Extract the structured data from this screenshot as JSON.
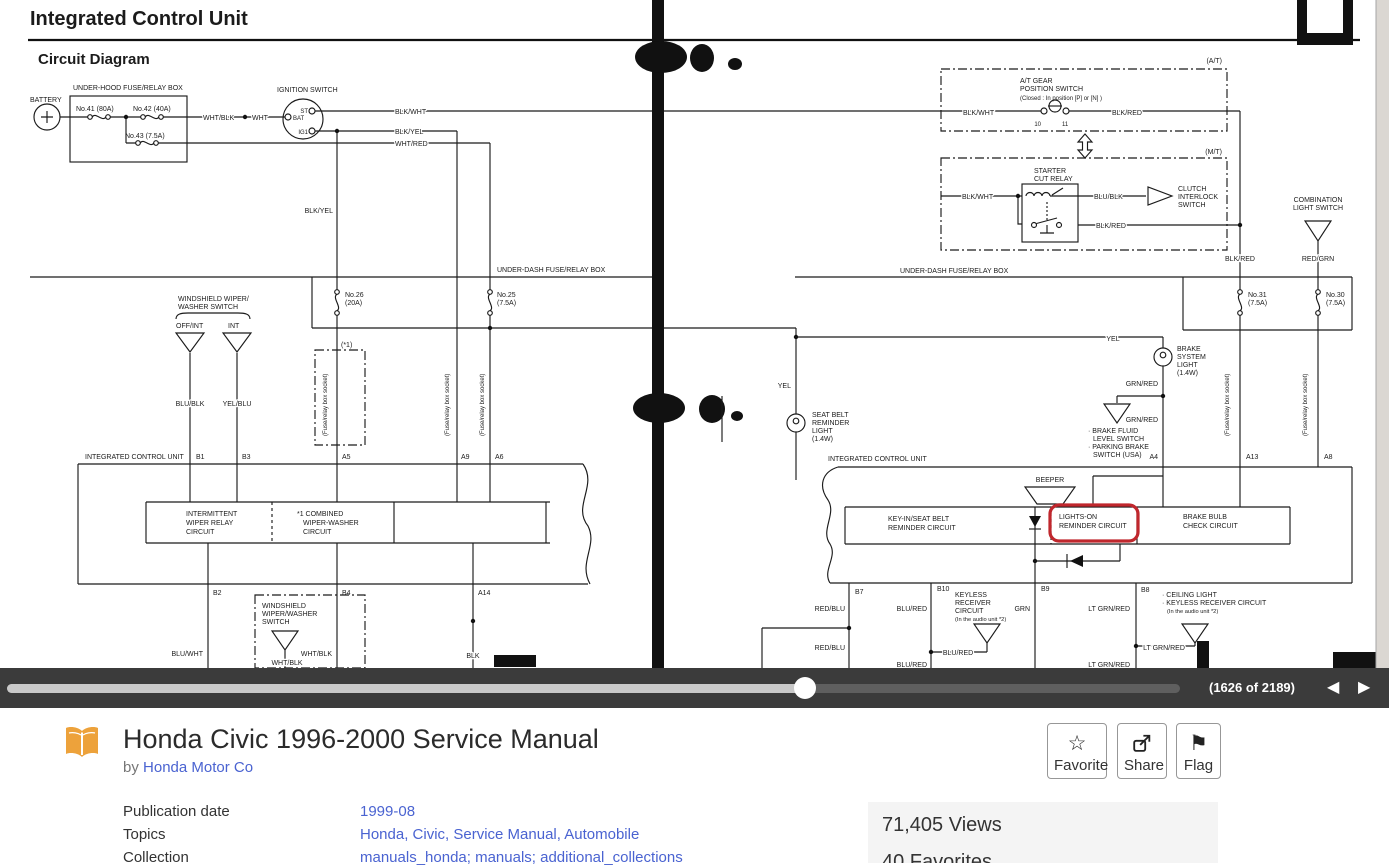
{
  "colors": {
    "highlight": "#c0272d",
    "link": "#4a63d1",
    "navbar_bg": "#3b3b3b",
    "ink": "#1b1b1b",
    "stats_bg": "#f4f4f4",
    "book_icon_orange": "#eda23b"
  },
  "viewer": {
    "page_indicator": "(1626 of 2189)",
    "prev_icon": "◀",
    "next_icon": "▶"
  },
  "book": {
    "title": "Honda Civic 1996-2000 Service Manual",
    "by_label": "by",
    "author": "Honda Motor Co",
    "actions": [
      {
        "label": "Favorite",
        "icon": "☆"
      },
      {
        "label": "Share",
        "icon": "share"
      },
      {
        "label": "Flag",
        "icon": "⚑"
      }
    ],
    "metadata": [
      {
        "label": "Publication date",
        "value": "1999-08"
      },
      {
        "label": "Topics",
        "value": "Honda, Civic, Service Manual, Automobile"
      },
      {
        "label": "Collection",
        "value": "manuals_honda; manuals; additional_collections"
      }
    ],
    "stats": {
      "views": "71,405 Views",
      "favorites_partial": "40 Favorites"
    }
  },
  "diagram": {
    "labels": [
      {
        "name": "page-heading",
        "x": 30,
        "y": 25,
        "t": "Integrated Control Unit",
        "s": 20,
        "b": 1
      },
      {
        "name": "section-heading",
        "x": 38,
        "y": 64,
        "t": "Circuit Diagram",
        "s": 15,
        "b": 1
      },
      {
        "name": "battery-label",
        "x": 30,
        "y": 102,
        "t": "BATTERY"
      },
      {
        "name": "underhood-box-label",
        "x": 73,
        "y": 90,
        "t": "UNDER-HOOD FUSE/RELAY BOX"
      },
      {
        "name": "fuse41-label",
        "x": 76,
        "y": 111,
        "t": "No.41 (80A)"
      },
      {
        "name": "fuse42-label",
        "x": 133,
        "y": 111,
        "t": "No.42 (40A)"
      },
      {
        "name": "fuse43-label",
        "x": 125,
        "y": 138,
        "t": "No.43 (7.5A)"
      },
      {
        "name": "wire-wht-blk",
        "x": 203,
        "y": 120,
        "t": "WHT/BLK",
        "h": 1
      },
      {
        "name": "wire-wht",
        "x": 252,
        "y": 120,
        "t": "WHT",
        "h": 1
      },
      {
        "name": "ignition-switch-label",
        "x": 277,
        "y": 92,
        "t": "IGNITION SWITCH"
      },
      {
        "name": "ign-st",
        "x": 308,
        "y": 113,
        "t": "ST",
        "a": "e",
        "s": 6
      },
      {
        "name": "ign-bat",
        "x": 293,
        "y": 120,
        "t": "BAT",
        "s": 6
      },
      {
        "name": "ign-ig1",
        "x": 308,
        "y": 134,
        "t": "IG1",
        "a": "e",
        "s": 6
      },
      {
        "name": "wire-blk-wht-1",
        "x": 395,
        "y": 114,
        "t": "BLK/WHT",
        "h": 1
      },
      {
        "name": "wire-blk-yel-1",
        "x": 395,
        "y": 134,
        "t": "BLK/YEL",
        "h": 1
      },
      {
        "name": "wire-wht-red",
        "x": 395,
        "y": 146,
        "t": "WHT/RED",
        "h": 1
      },
      {
        "name": "at-tag",
        "x": 1222,
        "y": 63,
        "t": "(A/T)",
        "a": "e"
      },
      {
        "name": "at-switch-label-1",
        "x": 1020,
        "y": 83,
        "t": "A/T GEAR"
      },
      {
        "name": "at-switch-label-2",
        "x": 1020,
        "y": 91,
        "t": "POSITION SWITCH"
      },
      {
        "name": "at-switch-label-3",
        "x": 1020,
        "y": 100,
        "t": "(Closed : In position [P] or [N] )",
        "s": 6
      },
      {
        "name": "at-term-10",
        "x": 1041,
        "y": 126,
        "t": "10",
        "a": "e",
        "s": 6
      },
      {
        "name": "at-term-11",
        "x": 1062,
        "y": 126,
        "t": "11",
        "s": 6
      },
      {
        "name": "wire-blk-wht-2",
        "x": 963,
        "y": 115,
        "t": "BLK/WHT",
        "h": 1
      },
      {
        "name": "wire-blk-red-1",
        "x": 1112,
        "y": 115,
        "t": "BLK/RED",
        "h": 1
      },
      {
        "name": "mt-tag",
        "x": 1222,
        "y": 154,
        "t": "(M/T)",
        "a": "e"
      },
      {
        "name": "starter-relay-label-1",
        "x": 1034,
        "y": 173,
        "t": "STARTER"
      },
      {
        "name": "starter-relay-label-2",
        "x": 1034,
        "y": 181,
        "t": "CUT RELAY"
      },
      {
        "name": "wire-blk-wht-3",
        "x": 962,
        "y": 199,
        "t": "BLK/WHT",
        "h": 1
      },
      {
        "name": "wire-blu-blk",
        "x": 1094,
        "y": 199,
        "t": "BLU/BLK",
        "h": 1
      },
      {
        "name": "clutch-label-1",
        "x": 1178,
        "y": 191,
        "t": "CLUTCH"
      },
      {
        "name": "clutch-label-2",
        "x": 1178,
        "y": 199,
        "t": "INTERLOCK"
      },
      {
        "name": "clutch-label-3",
        "x": 1178,
        "y": 207,
        "t": "SWITCH"
      },
      {
        "name": "wire-blk-red-2",
        "x": 1096,
        "y": 228,
        "t": "BLK/RED",
        "h": 1
      },
      {
        "name": "combo-label-1",
        "x": 1318,
        "y": 202,
        "t": "COMBINATION",
        "a": "m"
      },
      {
        "name": "combo-label-2",
        "x": 1318,
        "y": 210,
        "t": "LIGHT SWITCH",
        "a": "m"
      },
      {
        "name": "wire-red-grn",
        "x": 1318,
        "y": 261,
        "t": "RED/GRN",
        "a": "m",
        "h": 1
      },
      {
        "name": "wire-blk-red-3",
        "x": 1240,
        "y": 261,
        "t": "BLK/RED",
        "a": "m",
        "h": 1
      },
      {
        "name": "underdash-left-label",
        "x": 497,
        "y": 272,
        "t": "UNDER-DASH FUSE/RELAY BOX"
      },
      {
        "name": "underdash-right-label",
        "x": 900,
        "y": 273,
        "t": "UNDER-DASH FUSE/RELAY BOX"
      },
      {
        "name": "fuse26-label-1",
        "x": 345,
        "y": 297,
        "t": "No.26"
      },
      {
        "name": "fuse26-label-2",
        "x": 345,
        "y": 305,
        "t": "(20A)"
      },
      {
        "name": "fuse25-label-1",
        "x": 497,
        "y": 297,
        "t": "No.25"
      },
      {
        "name": "fuse25-label-2",
        "x": 497,
        "y": 305,
        "t": "(7.5A)"
      },
      {
        "name": "fuse31-label-1",
        "x": 1248,
        "y": 297,
        "t": "No.31"
      },
      {
        "name": "fuse31-label-2",
        "x": 1248,
        "y": 305,
        "t": "(7.5A)"
      },
      {
        "name": "fuse30-label-1",
        "x": 1326,
        "y": 297,
        "t": "No.30"
      },
      {
        "name": "fuse30-label-2",
        "x": 1326,
        "y": 305,
        "t": "(7.5A)"
      },
      {
        "name": "optional-box-label",
        "x": 341,
        "y": 347,
        "t": "(*1)"
      },
      {
        "name": "socket-label-1",
        "x": 327,
        "y": 436,
        "t": "(Fuse/relay box socket)",
        "r": 1,
        "s": 6
      },
      {
        "name": "socket-label-2",
        "x": 449,
        "y": 436,
        "t": "(Fuse/relay box socket)",
        "r": 1,
        "s": 6
      },
      {
        "name": "socket-label-3",
        "x": 484,
        "y": 436,
        "t": "(Fuse/relay box socket)",
        "r": 1,
        "s": 6
      },
      {
        "name": "socket-label-4",
        "x": 1229,
        "y": 436,
        "t": "(Fuse/relay box socket)",
        "r": 1,
        "s": 6
      },
      {
        "name": "socket-label-5",
        "x": 1307,
        "y": 436,
        "t": "(Fuse/relay box socket)",
        "r": 1,
        "s": 6
      },
      {
        "name": "wiper-switch-label-1",
        "x": 178,
        "y": 301,
        "t": "WINDSHIELD WIPER/"
      },
      {
        "name": "wiper-switch-label-2",
        "x": 178,
        "y": 309,
        "t": "WASHER SWITCH"
      },
      {
        "name": "wiper-offint-label",
        "x": 176,
        "y": 328,
        "t": "OFF/INT"
      },
      {
        "name": "wiper-int-label",
        "x": 228,
        "y": 328,
        "t": "INT"
      },
      {
        "name": "wire-blu-blk-2",
        "x": 190,
        "y": 406,
        "t": "BLU/BLK",
        "a": "m",
        "h": 1
      },
      {
        "name": "wire-yel-blu",
        "x": 237,
        "y": 406,
        "t": "YEL/BLU",
        "a": "m",
        "h": 1
      },
      {
        "name": "wire-blk-yel-2",
        "x": 333,
        "y": 213,
        "t": "BLK/YEL",
        "a": "e",
        "h": 1
      },
      {
        "name": "wire-yel-1",
        "x": 791,
        "y": 388,
        "t": "YEL",
        "a": "e",
        "h": 1
      },
      {
        "name": "wire-yel-2",
        "x": 1113,
        "y": 341,
        "t": "YEL",
        "a": "m",
        "h": 1
      },
      {
        "name": "seatbelt-label-1",
        "x": 812,
        "y": 417,
        "t": "SEAT BELT"
      },
      {
        "name": "seatbelt-label-2",
        "x": 812,
        "y": 425,
        "t": "REMINDER"
      },
      {
        "name": "seatbelt-label-3",
        "x": 812,
        "y": 433,
        "t": "LIGHT"
      },
      {
        "name": "seatbelt-label-4",
        "x": 812,
        "y": 441,
        "t": "(1.4W)"
      },
      {
        "name": "brakelight-label-1",
        "x": 1177,
        "y": 351,
        "t": "BRAKE"
      },
      {
        "name": "brakelight-label-2",
        "x": 1177,
        "y": 359,
        "t": "SYSTEM"
      },
      {
        "name": "brakelight-label-3",
        "x": 1177,
        "y": 367,
        "t": "LIGHT"
      },
      {
        "name": "brakelight-label-4",
        "x": 1177,
        "y": 375,
        "t": "(1.4W)"
      },
      {
        "name": "wire-grn-red-1",
        "x": 1158,
        "y": 386,
        "t": "GRN/RED",
        "a": "e",
        "h": 1
      },
      {
        "name": "wire-grn-red-2",
        "x": 1158,
        "y": 422,
        "t": "GRN/RED",
        "a": "e",
        "h": 1
      },
      {
        "name": "brakefluid-label-1",
        "x": 1088,
        "y": 433,
        "t": "· BRAKE FLUID"
      },
      {
        "name": "brakefluid-label-2",
        "x": 1093,
        "y": 441,
        "t": "LEVEL SWITCH"
      },
      {
        "name": "brakefluid-label-3",
        "x": 1088,
        "y": 449,
        "t": "· PARKING BRAKE"
      },
      {
        "name": "brakefluid-label-4",
        "x": 1093,
        "y": 457,
        "t": "SWITCH (USA)"
      },
      {
        "name": "icu-right-label",
        "x": 828,
        "y": 461,
        "t": "INTEGRATED CONTROL UNIT"
      },
      {
        "name": "beeper-label",
        "x": 1050,
        "y": 482,
        "t": "BEEPER",
        "a": "m"
      },
      {
        "name": "keyin-label-1",
        "x": 888,
        "y": 521,
        "t": "KEY-IN/SEAT BELT"
      },
      {
        "name": "keyin-label-2",
        "x": 888,
        "y": 530,
        "t": "REMINDER CIRCUIT"
      },
      {
        "name": "lightson-label-1",
        "x": 1059,
        "y": 519,
        "t": "LIGHTS-ON"
      },
      {
        "name": "lightson-label-2",
        "x": 1059,
        "y": 528,
        "t": "REMINDER CIRCUIT"
      },
      {
        "name": "brakebulb-label-1",
        "x": 1183,
        "y": 519,
        "t": "BRAKE BULB"
      },
      {
        "name": "brakebulb-label-2",
        "x": 1183,
        "y": 528,
        "t": "CHECK CIRCUIT"
      },
      {
        "name": "term-a4",
        "x": 1158,
        "y": 459,
        "t": "A4",
        "a": "e"
      },
      {
        "name": "term-a13",
        "x": 1246,
        "y": 459,
        "t": "A13"
      },
      {
        "name": "term-a8",
        "x": 1324,
        "y": 459,
        "t": "A8"
      },
      {
        "name": "icu-left-label",
        "x": 85,
        "y": 459,
        "t": "INTEGRATED CONTROL UNIT"
      },
      {
        "name": "term-b1",
        "x": 196,
        "y": 459,
        "t": "B1"
      },
      {
        "name": "term-b3",
        "x": 242,
        "y": 459,
        "t": "B3"
      },
      {
        "name": "term-a5",
        "x": 342,
        "y": 459,
        "t": "A5"
      },
      {
        "name": "term-a9",
        "x": 461,
        "y": 459,
        "t": "A9"
      },
      {
        "name": "term-a6",
        "x": 495,
        "y": 459,
        "t": "A6"
      },
      {
        "name": "intermittent-label-1",
        "x": 186,
        "y": 516,
        "t": "INTERMITTENT"
      },
      {
        "name": "intermittent-label-2",
        "x": 186,
        "y": 525,
        "t": "WIPER RELAY"
      },
      {
        "name": "intermittent-label-3",
        "x": 186,
        "y": 534,
        "t": "CIRCUIT"
      },
      {
        "name": "combined-label-1",
        "x": 297,
        "y": 516,
        "t": "*1 COMBINED"
      },
      {
        "name": "combined-label-2",
        "x": 303,
        "y": 525,
        "t": "WIPER-WASHER"
      },
      {
        "name": "combined-label-3",
        "x": 303,
        "y": 534,
        "t": "CIRCUIT"
      },
      {
        "name": "term-b2",
        "x": 213,
        "y": 595,
        "t": "B2"
      },
      {
        "name": "term-b4",
        "x": 342,
        "y": 595,
        "t": "B4"
      },
      {
        "name": "term-a14",
        "x": 478,
        "y": 595,
        "t": "A14"
      },
      {
        "name": "windshield-label-1",
        "x": 262,
        "y": 608,
        "t": "WINDSHIELD"
      },
      {
        "name": "windshield-label-2",
        "x": 262,
        "y": 616,
        "t": "WIPER/WASHER"
      },
      {
        "name": "windshield-label-3",
        "x": 262,
        "y": 624,
        "t": "SWITCH"
      },
      {
        "name": "wire-blu-wht",
        "x": 203,
        "y": 656,
        "t": "BLU/WHT",
        "a": "e",
        "h": 1
      },
      {
        "name": "wire-wht-blk-2",
        "x": 287,
        "y": 665,
        "t": "WHT/BLK",
        "a": "m",
        "h": 1
      },
      {
        "name": "wire-wht-blk-3",
        "x": 332,
        "y": 656,
        "t": "WHT/BLK",
        "a": "e",
        "h": 1
      },
      {
        "name": "wire-blk",
        "x": 473,
        "y": 658,
        "t": "BLK",
        "a": "m",
        "h": 1
      },
      {
        "name": "term-b7",
        "x": 855,
        "y": 594,
        "t": "B7"
      },
      {
        "name": "term-b10",
        "x": 937,
        "y": 591,
        "t": "B10"
      },
      {
        "name": "term-b9",
        "x": 1041,
        "y": 591,
        "t": "B9"
      },
      {
        "name": "term-b8",
        "x": 1141,
        "y": 592,
        "t": "B8"
      },
      {
        "name": "wire-red-blu-1",
        "x": 845,
        "y": 611,
        "t": "RED/BLU",
        "a": "e",
        "h": 1
      },
      {
        "name": "wire-red-blu-2",
        "x": 845,
        "y": 650,
        "t": "RED/BLU",
        "a": "e",
        "h": 1
      },
      {
        "name": "wire-blu-red-1",
        "x": 927,
        "y": 611,
        "t": "BLU/RED",
        "a": "e",
        "h": 1
      },
      {
        "name": "keyless-label-1",
        "x": 955,
        "y": 597,
        "t": "KEYLESS"
      },
      {
        "name": "keyless-label-2",
        "x": 955,
        "y": 605,
        "t": "RECEIVER"
      },
      {
        "name": "keyless-label-3",
        "x": 955,
        "y": 613,
        "t": "CIRCUIT"
      },
      {
        "name": "keyless-label-4",
        "x": 955,
        "y": 621,
        "t": "(In the audio unit *2)",
        "s": 5.7
      },
      {
        "name": "wire-blu-red-2",
        "x": 958,
        "y": 655,
        "t": "BLU/RED",
        "a": "m",
        "h": 1
      },
      {
        "name": "wire-blu-red-3",
        "x": 927,
        "y": 667,
        "t": "BLU/RED",
        "a": "e",
        "h": 1
      },
      {
        "name": "wire-grn",
        "x": 1030,
        "y": 611,
        "t": "GRN",
        "a": "e",
        "h": 1
      },
      {
        "name": "wire-ltgrnred-1",
        "x": 1130,
        "y": 611,
        "t": "LT GRN/RED",
        "a": "e",
        "h": 1
      },
      {
        "name": "wire-ltgrnred-2",
        "x": 1164,
        "y": 650,
        "t": "LT GRN/RED",
        "a": "m",
        "h": 1
      },
      {
        "name": "ceiling-label-1",
        "x": 1162,
        "y": 597,
        "t": "· CEILING LIGHT"
      },
      {
        "name": "ceiling-label-2",
        "x": 1162,
        "y": 605,
        "t": "· KEYLESS RECEIVER CIRCUIT"
      },
      {
        "name": "ceiling-label-3",
        "x": 1167,
        "y": 613,
        "t": "(In the audio unit *2)",
        "s": 5.7
      },
      {
        "name": "wire-ltgrnred-3",
        "x": 1130,
        "y": 667,
        "t": "LT GRN/RED",
        "a": "e",
        "h": 1
      }
    ]
  }
}
